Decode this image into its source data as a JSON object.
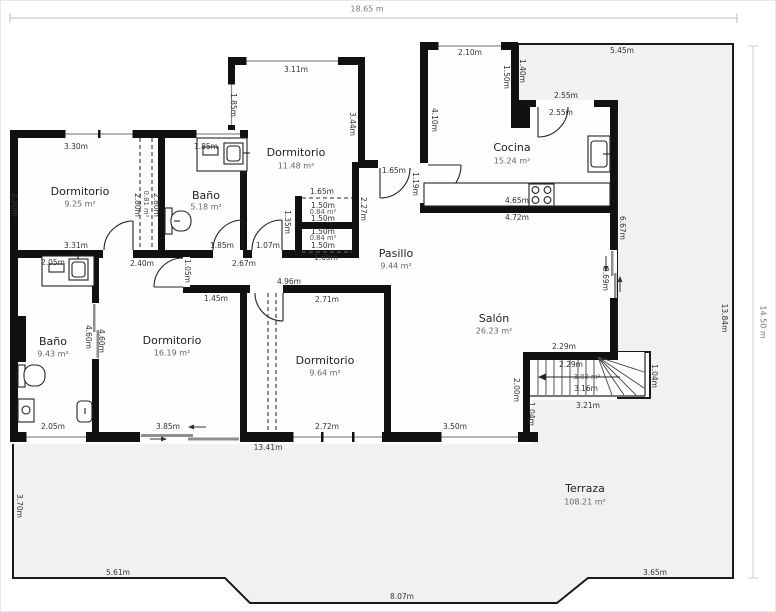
{
  "rulers": {
    "width": "18.65 m",
    "height": "14.50 m"
  },
  "rooms": {
    "dormitorio1": {
      "name": "Dormitorio",
      "area": "9.25 m²"
    },
    "bano1": {
      "name": "Baño",
      "area": "5.18 m²"
    },
    "dormitorio2": {
      "name": "Dormitorio",
      "area": "11.48 m²"
    },
    "cocina": {
      "name": "Cocina",
      "area": "15.24 m²"
    },
    "pasillo": {
      "name": "Pasillo",
      "area": "9.44 m²"
    },
    "bano2": {
      "name": "Baño",
      "area": "9.43 m²"
    },
    "dormitorio3": {
      "name": "Dormitorio",
      "area": "16.19 m²"
    },
    "dormitorio4": {
      "name": "Dormitorio",
      "area": "9.64 m²"
    },
    "salon": {
      "name": "Salón",
      "area": "26.23 m²"
    },
    "terraza": {
      "name": "Terraza",
      "area": "108.21 m²"
    },
    "escalera": {
      "area": "3.03 m²"
    },
    "armario1": {
      "area": "0.84 m²"
    },
    "armario2": {
      "area": "0.84 m²"
    },
    "hueco": {
      "area": "0.81 m²"
    }
  },
  "dims": {
    "top_330": "3.30m",
    "bano1_top_185": "1.85m",
    "top_311": "3.11m",
    "win_left_185": "1.85m",
    "top_210": "2.10m",
    "top_545": "5.45m",
    "v_140": "1.40m",
    "v_150": "1.50m",
    "cocina_255a": "2.55m",
    "cocina_255b": "2.55m",
    "v_410": "4.10m",
    "left_280": "2.80m",
    "v_344": "3.44m",
    "door_165": "1.65m",
    "v_119": "1.19m",
    "mid_331": "3.31m",
    "sliver_280a": "2.80m",
    "sliver_280b": "2.80m",
    "bano1_door_185": "1.85m",
    "door_107": "1.07m",
    "mid_240": "2.40m",
    "mid_267": "2.67m",
    "v_105": "1.05m",
    "mid_145": "1.45m",
    "mid_496": "4.96m",
    "mid_271": "2.71m",
    "closet_165a": "1.65m",
    "closet_150a": "1.50m",
    "closet_150b": "1.50m",
    "closet_150c": "1.50m",
    "closet_150d": "1.50m",
    "closet_165b": "1.65m",
    "v_135": "1.35m",
    "v_227": "2.27m",
    "cocina_465": "4.65m",
    "cocina_472": "4.72m",
    "v_667": "6.67m",
    "v_369": "3.69m",
    "v_460a": "4.60m",
    "v_460b": "4.60m",
    "bano2_205a": "2.05m",
    "bano2_205b": "2.05m",
    "bot_385": "3.85m",
    "bot_272": "2.72m",
    "bot_350": "3.50m",
    "bot_1341": "13.41m",
    "v_200": "2.00m",
    "v_104a": "1.04m",
    "stair_229a": "2.29m",
    "stair_229b": "2.29m",
    "stair_316": "3.16m",
    "stair_321": "3.21m",
    "v_104b": "1.04m",
    "terr_370": "3.70m",
    "terr_561": "5.61m",
    "terr_807": "8.07m",
    "terr_365": "3.65m",
    "terr_1384": "13.84m"
  }
}
